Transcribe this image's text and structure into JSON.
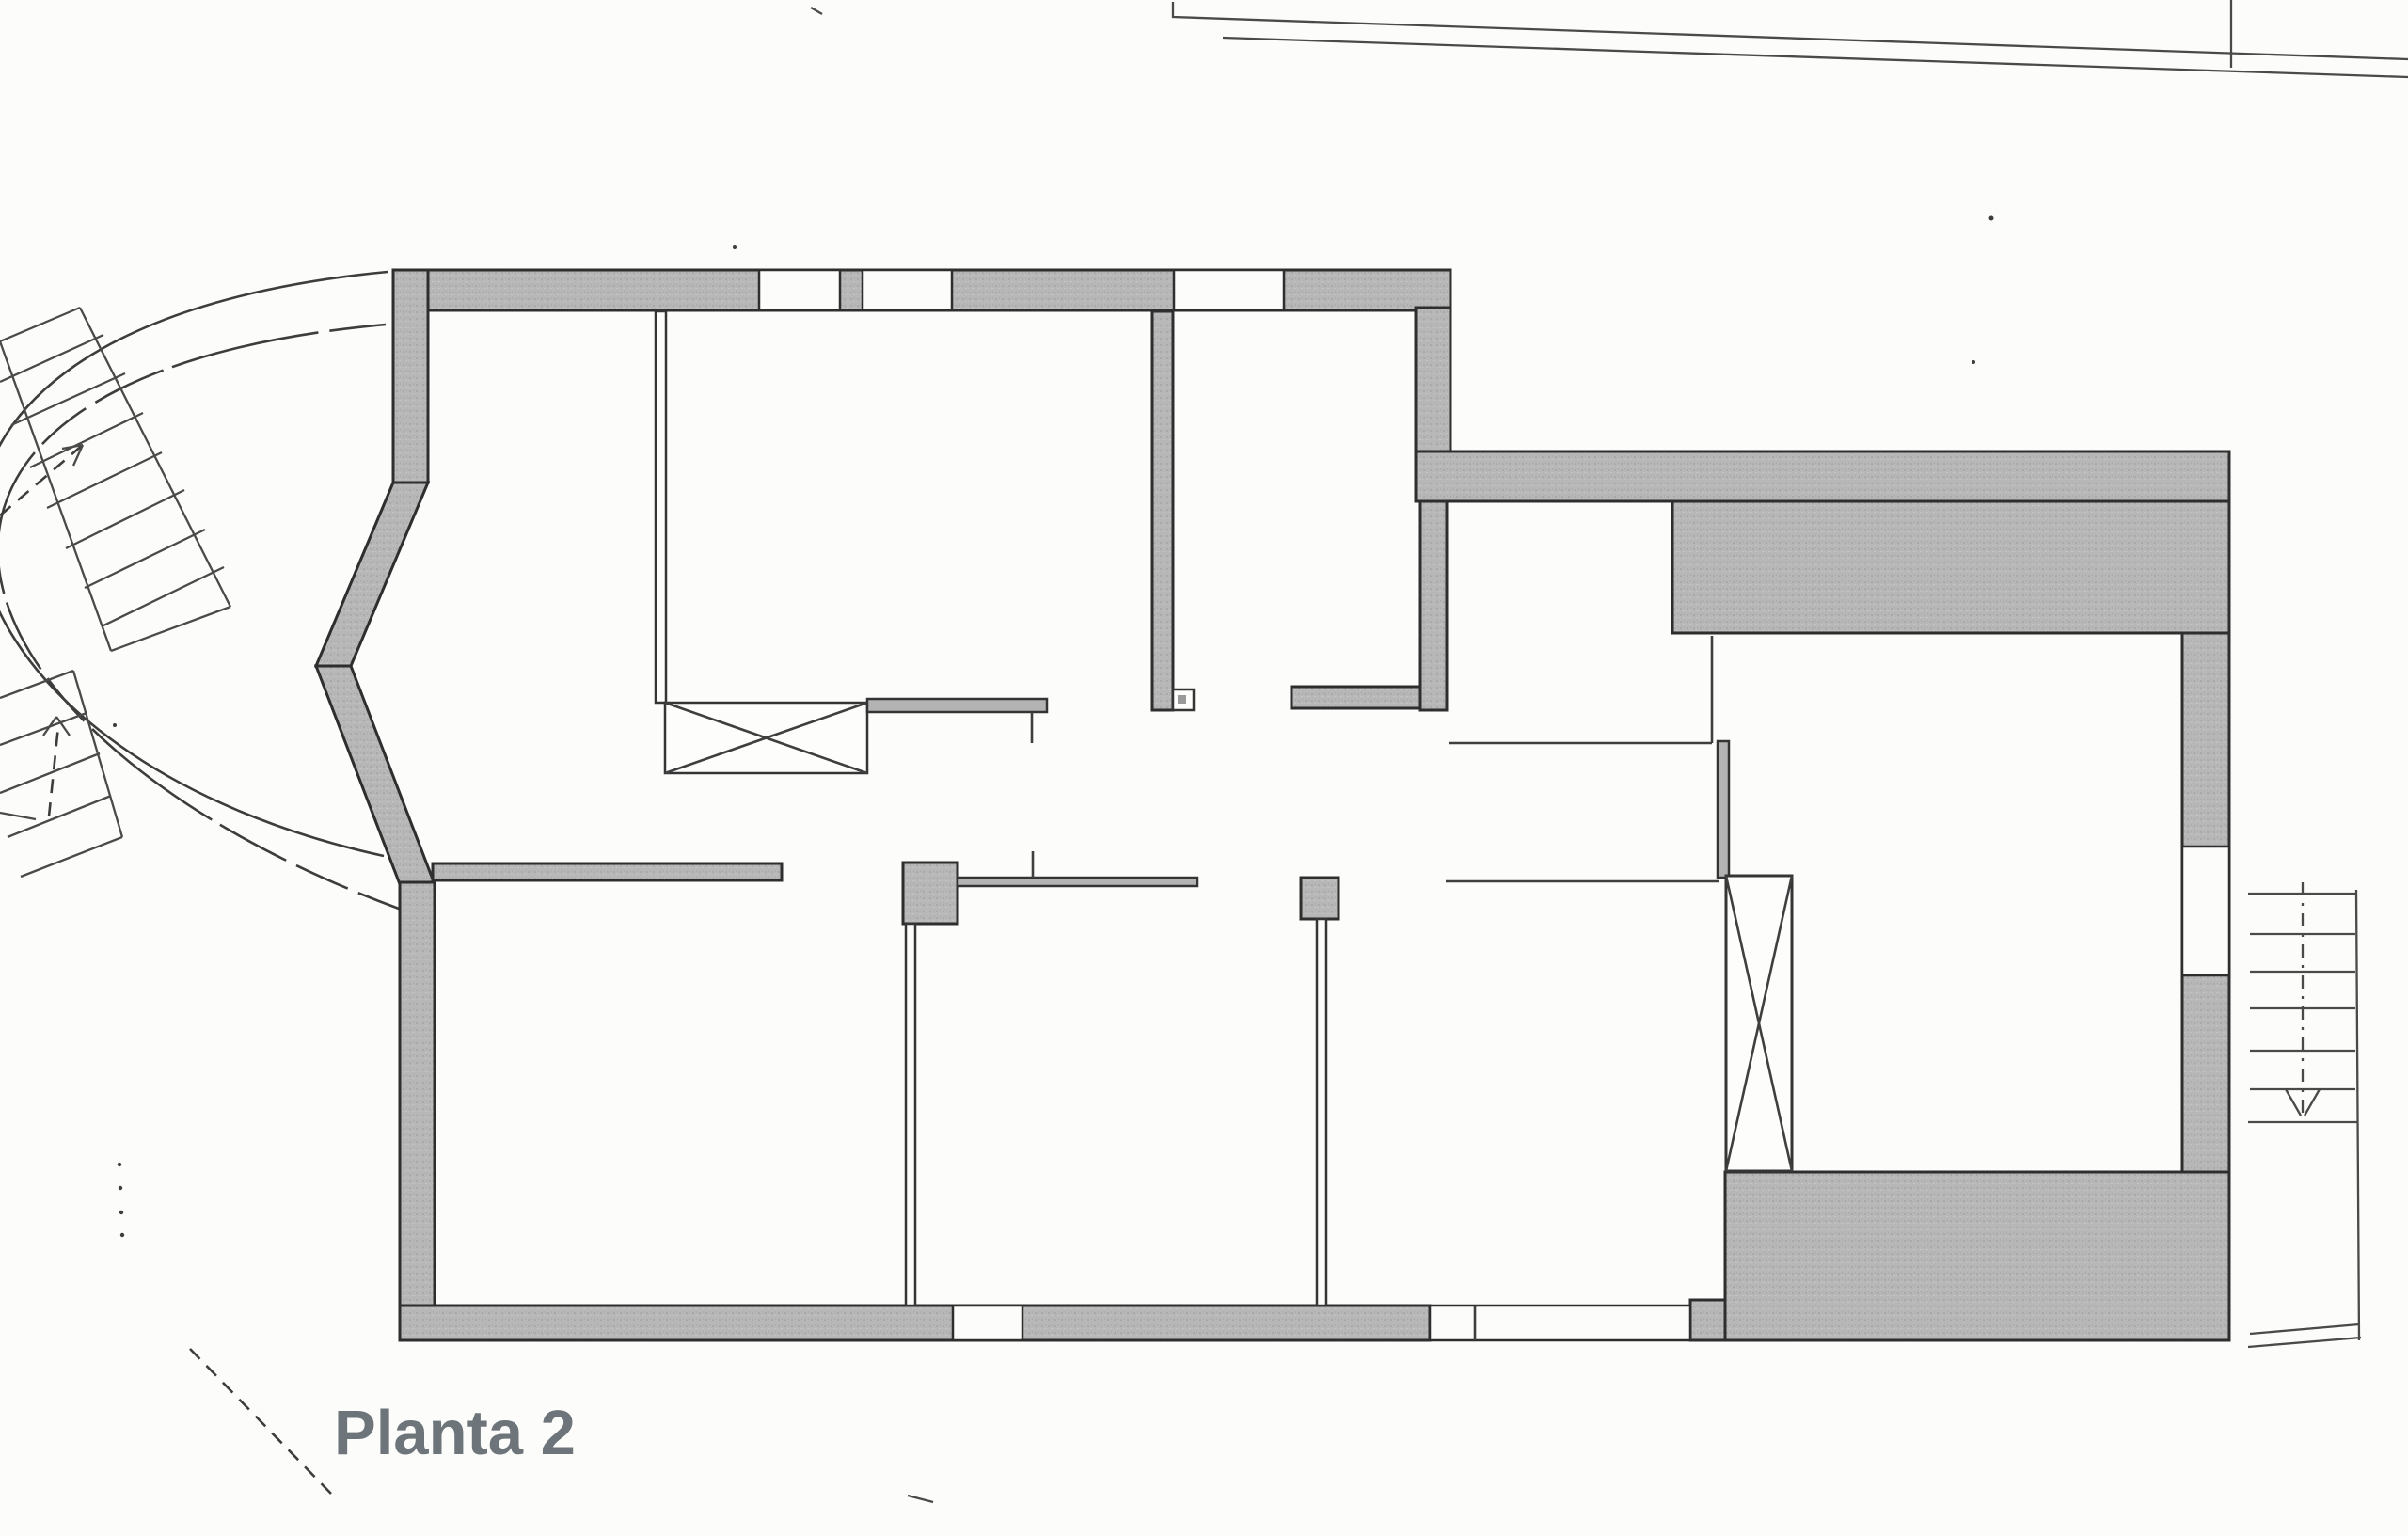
{
  "title": {
    "label": "Planta 2",
    "color": "#6d757b"
  },
  "colors": {
    "paper": "#fcfcfa",
    "wall_fill": "#b7b7b7",
    "wall_outline": "#2e2e2e",
    "thin_line": "#3f3f3f",
    "label_color": "#6d757b"
  },
  "plan": {
    "type": "architectural-floor-plan",
    "floor_label": "Planta 2",
    "features": [
      "curved-driveway",
      "exterior-stairs-left",
      "exterior-stairs-lower-left",
      "building-outer-walls",
      "facade-windows",
      "terrace-mass-top-right",
      "terrace-mass-bottom-right",
      "interior-partitions",
      "kitchen-counter-x",
      "elevator-shaft-x",
      "exterior-stairs-right",
      "site-boundary-lines"
    ]
  }
}
